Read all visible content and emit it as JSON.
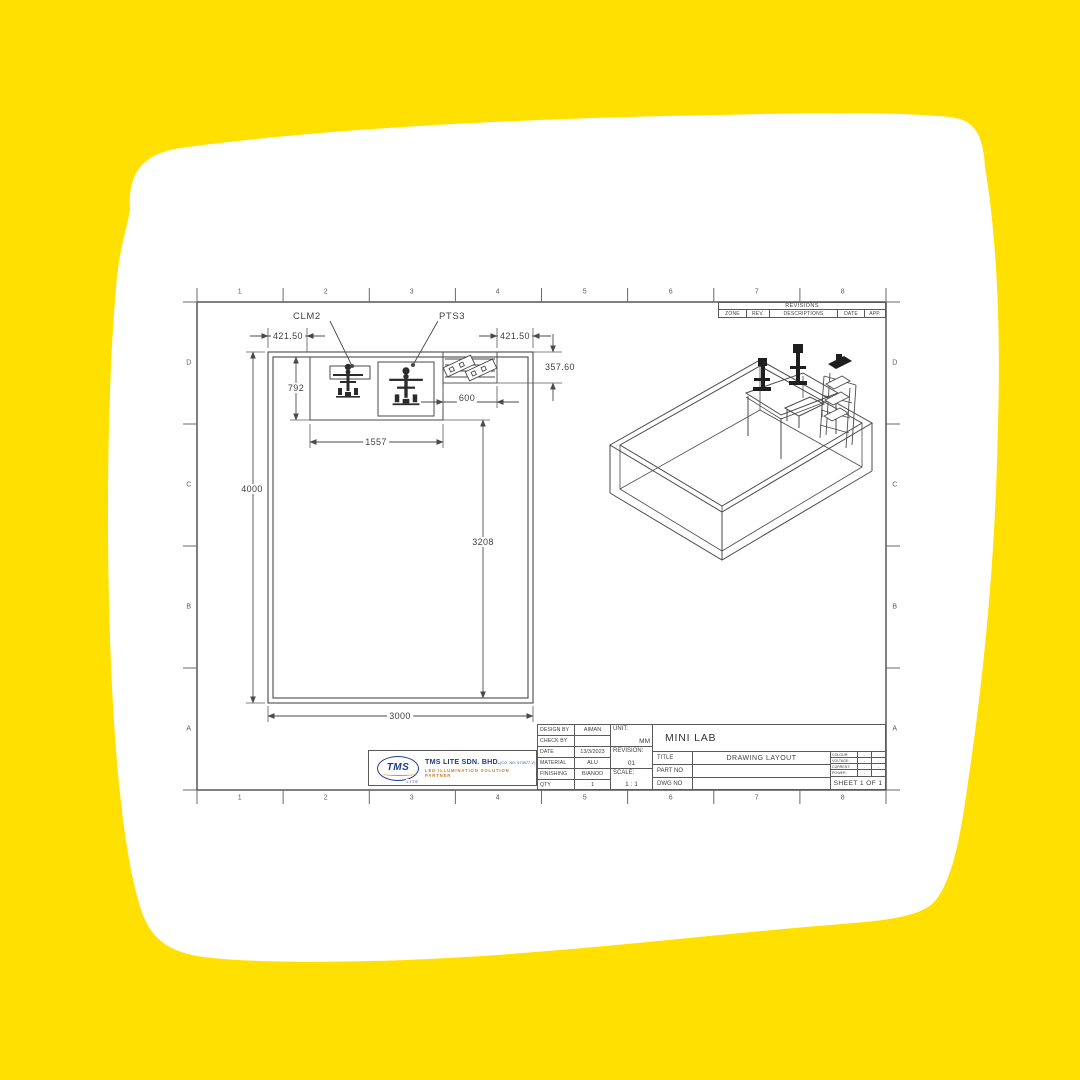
{
  "colors": {
    "canvas": "#FFE000",
    "paper": "#FFFFFF",
    "line": "#4a4a4a",
    "text": "#3f3f3f",
    "logo_navy": "#1d3d8f",
    "logo_gold": "#e09520"
  },
  "sheet": {
    "zones_top": [
      "1",
      "2",
      "3",
      "4",
      "5",
      "6",
      "7",
      "8"
    ],
    "zones_bottom": [
      "1",
      "2",
      "3",
      "4",
      "5",
      "6",
      "7",
      "8"
    ],
    "zones_left": [
      "D",
      "C",
      "B",
      "A"
    ],
    "zones_right": [
      "D",
      "C",
      "B",
      "A"
    ]
  },
  "revisions": {
    "title": "REVISIONS",
    "columns": [
      "ZONE",
      "REV.",
      "DESCRIPTIONS",
      "DATE",
      "APP."
    ]
  },
  "plan": {
    "labels": {
      "machine1": "CLM2",
      "machine2": "PTS3"
    },
    "dims": {
      "offset_left": "421.50",
      "offset_right": "421.50",
      "rack_depth": "357.60",
      "bench_depth": "792",
      "rack_width": "600",
      "bench_width": "1557",
      "room_length": "4000",
      "clear_length": "3208",
      "room_width": "3000"
    }
  },
  "title_block": {
    "design_by_label": "DESIGN BY",
    "design_by": "AIMAN",
    "check_by_label": "CHECK BY",
    "check_by": "",
    "date_label": "DATE",
    "date": "13/3/2023",
    "material_label": "MATERIAL",
    "material": "ALU",
    "finishing_label": "FINISHING",
    "finishing": "B/ANOD",
    "qty_label": "QTY",
    "qty": "1",
    "unit_label": "UNIT:",
    "unit": "MM",
    "revision_label": "REVISION:",
    "revision": "01",
    "scale_label": "SCALE:",
    "scale": "1 : 1",
    "project": "MINI LAB",
    "title_label": "TITLE",
    "title": "DRAWING LAYOUT",
    "part_no_label": "PART NO",
    "part_no": "",
    "dwg_no_label": "DWG NO",
    "dwg_no": "",
    "electrical": [
      {
        "label": "COLOUR:",
        "v1": "-",
        "v2": "-"
      },
      {
        "label": "VOLTAGE:",
        "v1": "-",
        "v2": "-"
      },
      {
        "label": "CURRENT:",
        "v1": "-",
        "v2": "-"
      },
      {
        "label": "POWER:",
        "v1": "-",
        "v2": "-"
      }
    ],
    "sheet_info": "SHEET 1 OF 1"
  },
  "logo": {
    "mark": "TMS",
    "mark_sub": "LITE",
    "company": "TMS LITE SDN. BHD.",
    "company_reg": "(CO. NO: 573977-V)",
    "tagline": "LED ILLUMINATION SOLUTION PARTNER"
  }
}
